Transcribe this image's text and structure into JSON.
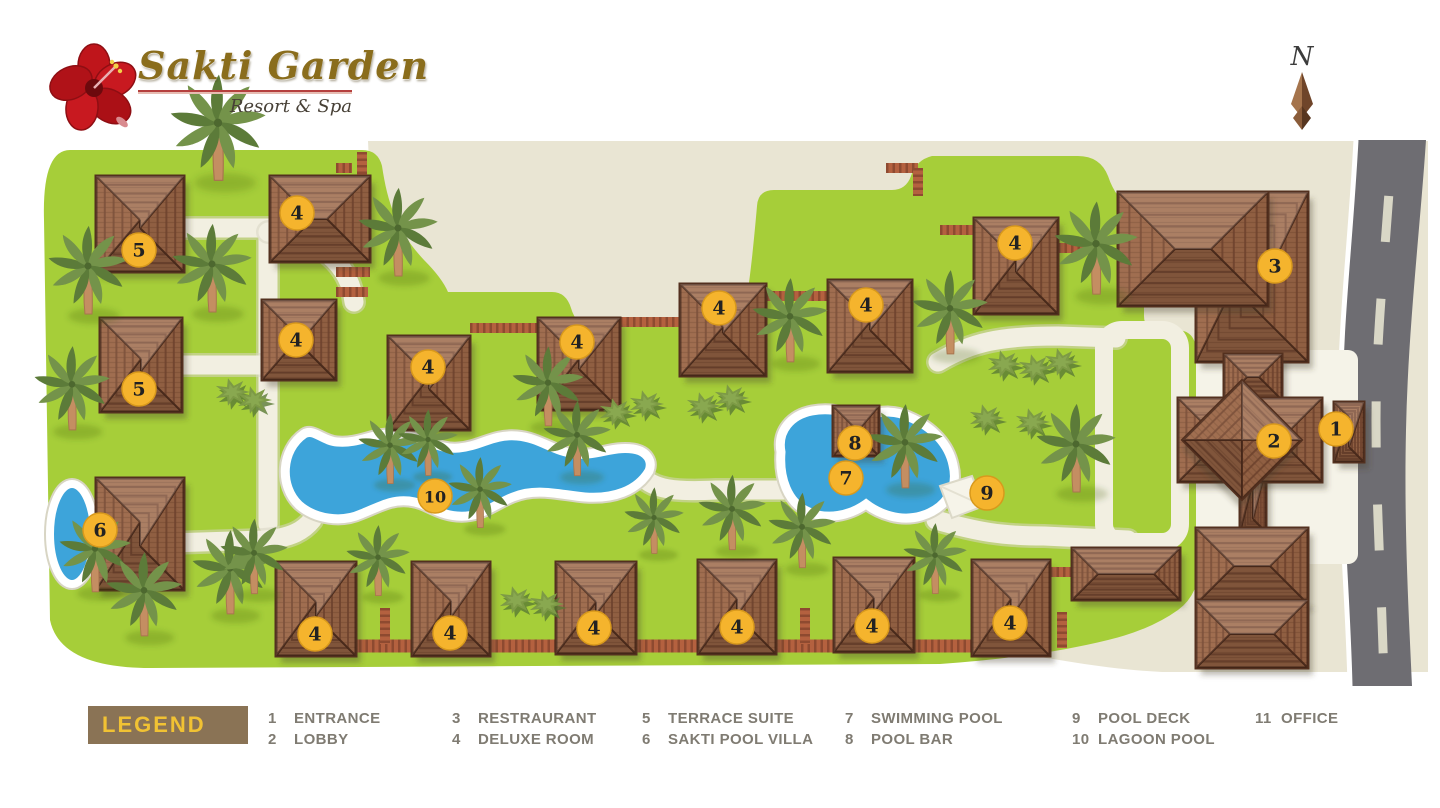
{
  "header": {
    "title": "Sakti Garden",
    "subtitle": "Resort & Spa",
    "logo": "hibiscus-flower-logo",
    "north_label": "N"
  },
  "legend": {
    "label": "LEGEND",
    "items": [
      {
        "num": "1",
        "label": "ENTRANCE"
      },
      {
        "num": "2",
        "label": "LOBBY"
      },
      {
        "num": "3",
        "label": "RESTRAURANT"
      },
      {
        "num": "4",
        "label": "DELUXE ROOM"
      },
      {
        "num": "5",
        "label": "TERRACE SUITE"
      },
      {
        "num": "6",
        "label": "SAKTI POOL VILLA"
      },
      {
        "num": "7",
        "label": "SWIMMING POOL"
      },
      {
        "num": "8",
        "label": "POOL BAR"
      },
      {
        "num": "9",
        "label": "POOL DECK"
      },
      {
        "num": "10",
        "label": "LAGOON POOL"
      },
      {
        "num": "11",
        "label": "OFFICE"
      }
    ],
    "column_lefts": [
      268,
      452,
      642,
      845,
      1072,
      1255
    ]
  },
  "map": {
    "colors": {
      "grass": "#a6ce39",
      "sand": "#e9e5d3",
      "road": "#6e6d72",
      "road_dash": "#d9d7c6",
      "road_stripe": "#ffffff",
      "path": "#f2efe1",
      "path_edge": "#d9d6c4",
      "water": "#3da4da",
      "water_rim": "#ffffff",
      "roof_base": "#9b6747",
      "roof_ring": "#754831",
      "roof_outline": "#53301f",
      "brick": "#b4613f",
      "brick_dark": "#8e4a30",
      "marker_bg": "#f5b42d",
      "marker_border": "#d8991c",
      "marker_text": "#222222",
      "palm_dark": "#5c7b39",
      "palm_light": "#74934a",
      "trunk": "#c48e62",
      "bush": "#7d9a46",
      "bush_dark": "#5a7a34",
      "plaza": "#f5f3e8",
      "deck": "#f6f4e9",
      "legend_box": "#8a7355",
      "legend_title": "#f1c233",
      "legend_text": "#7f7b72",
      "title_gold": "#8a6d1c",
      "underline_red": "#b5403e",
      "flower_red": "#c0161c"
    },
    "markers": [
      {
        "n": "5",
        "name": "terrace-suite",
        "x": 139,
        "y": 250
      },
      {
        "n": "5",
        "name": "terrace-suite",
        "x": 139,
        "y": 389
      },
      {
        "n": "4",
        "name": "deluxe-room",
        "x": 297,
        "y": 213
      },
      {
        "n": "4",
        "name": "deluxe-room",
        "x": 296,
        "y": 340
      },
      {
        "n": "4",
        "name": "deluxe-room",
        "x": 428,
        "y": 367
      },
      {
        "n": "4",
        "name": "deluxe-room",
        "x": 577,
        "y": 342
      },
      {
        "n": "4",
        "name": "deluxe-room",
        "x": 719,
        "y": 308
      },
      {
        "n": "4",
        "name": "deluxe-room",
        "x": 866,
        "y": 305
      },
      {
        "n": "4",
        "name": "deluxe-room",
        "x": 1015,
        "y": 243
      },
      {
        "n": "4",
        "name": "deluxe-room",
        "x": 315,
        "y": 634
      },
      {
        "n": "4",
        "name": "deluxe-room",
        "x": 450,
        "y": 633
      },
      {
        "n": "4",
        "name": "deluxe-room",
        "x": 594,
        "y": 628
      },
      {
        "n": "4",
        "name": "deluxe-room",
        "x": 737,
        "y": 627
      },
      {
        "n": "4",
        "name": "deluxe-room",
        "x": 872,
        "y": 626
      },
      {
        "n": "4",
        "name": "deluxe-room",
        "x": 1010,
        "y": 623
      },
      {
        "n": "6",
        "name": "sakti-pool-villa",
        "x": 100,
        "y": 530
      },
      {
        "n": "10",
        "name": "lagoon-pool",
        "x": 435,
        "y": 496
      },
      {
        "n": "7",
        "name": "swimming-pool",
        "x": 846,
        "y": 478
      },
      {
        "n": "8",
        "name": "pool-bar",
        "x": 855,
        "y": 443
      },
      {
        "n": "9",
        "name": "pool-deck",
        "x": 987,
        "y": 493
      },
      {
        "n": "3",
        "name": "restaurant",
        "x": 1275,
        "y": 266
      },
      {
        "n": "2",
        "name": "lobby",
        "x": 1274,
        "y": 441
      },
      {
        "n": "1",
        "name": "entrance",
        "x": 1336,
        "y": 429
      }
    ],
    "buildings": [
      {
        "name": "terrace-suite-building",
        "x": 96,
        "y": 176,
        "w": 88,
        "h": 96
      },
      {
        "name": "terrace-suite-building",
        "x": 100,
        "y": 318,
        "w": 82,
        "h": 94
      },
      {
        "name": "deluxe-room-building",
        "x": 270,
        "y": 176,
        "w": 100,
        "h": 86
      },
      {
        "name": "deluxe-room-building",
        "x": 262,
        "y": 300,
        "w": 74,
        "h": 80
      },
      {
        "name": "deluxe-room-building",
        "x": 388,
        "y": 336,
        "w": 82,
        "h": 94
      },
      {
        "name": "deluxe-room-building",
        "x": 538,
        "y": 318,
        "w": 82,
        "h": 92
      },
      {
        "name": "deluxe-room-building",
        "x": 680,
        "y": 284,
        "w": 86,
        "h": 92
      },
      {
        "name": "deluxe-room-building",
        "x": 828,
        "y": 280,
        "w": 84,
        "h": 92
      },
      {
        "name": "deluxe-room-building",
        "x": 974,
        "y": 218,
        "w": 84,
        "h": 96
      },
      {
        "name": "deluxe-room-building",
        "x": 276,
        "y": 562,
        "w": 80,
        "h": 94
      },
      {
        "name": "deluxe-room-building",
        "x": 412,
        "y": 562,
        "w": 78,
        "h": 94
      },
      {
        "name": "deluxe-room-building",
        "x": 556,
        "y": 562,
        "w": 80,
        "h": 92
      },
      {
        "name": "deluxe-room-building",
        "x": 698,
        "y": 560,
        "w": 78,
        "h": 94
      },
      {
        "name": "deluxe-room-building",
        "x": 834,
        "y": 558,
        "w": 80,
        "h": 94
      },
      {
        "name": "deluxe-room-building",
        "x": 972,
        "y": 560,
        "w": 78,
        "h": 96
      },
      {
        "name": "sakti-pool-villa-building",
        "x": 96,
        "y": 478,
        "w": 88,
        "h": 112
      },
      {
        "name": "restaurant-building",
        "x": 1196,
        "y": 192,
        "w": 112,
        "h": 170
      },
      {
        "name": "restaurant-building",
        "x": 1118,
        "y": 192,
        "w": 150,
        "h": 114
      },
      {
        "name": "restaurant-corridor",
        "x": 1224,
        "y": 354,
        "w": 58,
        "h": 46
      },
      {
        "name": "lobby-corridor",
        "x": 1240,
        "y": 468,
        "w": 26,
        "h": 64
      },
      {
        "name": "spa-building",
        "x": 1196,
        "y": 528,
        "w": 112,
        "h": 76
      },
      {
        "name": "spa-building",
        "x": 1196,
        "y": 600,
        "w": 112,
        "h": 68
      },
      {
        "name": "lobby-building",
        "x": 1178,
        "y": 398,
        "w": 144,
        "h": 84
      },
      {
        "name": "lobby-building",
        "x": 1200,
        "y": 398,
        "w": 84,
        "h": 84,
        "rot": 45
      },
      {
        "name": "office-building",
        "x": 1072,
        "y": 548,
        "w": 108,
        "h": 52
      },
      {
        "name": "pool-bar-building",
        "x": 833,
        "y": 406,
        "w": 46,
        "h": 50
      },
      {
        "name": "entrance-building",
        "x": 1334,
        "y": 402,
        "w": 30,
        "h": 60
      }
    ],
    "shapes": {
      "sand": "M 368,141 L 1428,141 L 1428,672 L 1162,672 C 1082,668 1022,650 962,648 L 430,648 L 395,520 L 375,300 Z",
      "grass": "M 70,150 L 362,150 Q 378,150 382,166 C 388,206 398,232 424,260 Q 442,278 448,292 L 552,292 Q 566,292 571,308 Q 576,326 592,326 L 724,326 Q 740,326 745,308 C 750,282 754,240 757,206 Q 758,190 774,190 L 892,190 Q 906,190 911,176 Q 916,160 932,156 L 1078,156 Q 1100,156 1108,176 Q 1116,200 1134,210 Q 1144,216 1144,232 L 1144,316 Q 1144,330 1160,330 L 1176,330 Q 1196,330 1196,352 L 1200,560 Q 1200,594 1178,610 Q 1150,630 1108,640 C 1060,652 1000,660 940,664 L 150,668 Q 60,668 50,620 L 44,220 Q 42,150 70,150 Z",
      "road": "M 1358,140 C 1352,250 1342,320 1342,420 C 1342,520 1350,600 1352,686 L 1412,686 C 1408,600 1404,520 1406,430 C 1408,330 1420,230 1426,140 Z",
      "road_stripe_left": "M 1356,140 C 1350,250 1340,320 1340,420 C 1340,520 1348,600 1350,686",
      "road_center": "M 1392,146 C 1386,250 1376,330 1376,420 C 1376,510 1382,590 1384,686",
      "plaza_rect": {
        "x": 1196,
        "y": 350,
        "w": 162,
        "h": 214
      },
      "walkways": [
        "M 183,228 L 268,228 L 268,524",
        "M 183,365 L 268,365",
        "M 268,232 C 322,238 350,266 354,302",
        "M 78,546 L 264,540 C 292,538 304,530 312,520",
        "M 640,474 C 652,490 676,492 716,490 L 806,490",
        "M 936,520 C 978,532 1002,536 1044,536 L 1128,540",
        "M 938,362 C 972,342 1000,336 1058,336 L 1116,338"
      ],
      "plaza_ring": {
        "x": 1104,
        "y": 330,
        "w": 76,
        "h": 212,
        "rx": 18
      },
      "bricks": [
        {
          "d": "M 336,168 L 352,168"
        },
        {
          "d": "M 362,152 L 362,186"
        },
        {
          "d": "M 336,272 L 370,272"
        },
        {
          "d": "M 336,292 L 368,292"
        },
        {
          "d": "M 470,328 L 538,328"
        },
        {
          "d": "M 620,322 L 680,322"
        },
        {
          "d": "M 766,296 L 828,296"
        },
        {
          "d": "M 886,168 L 918,168"
        },
        {
          "d": "M 918,168 L 918,196"
        },
        {
          "d": "M 940,230 L 974,230"
        },
        {
          "d": "M 1058,248 L 1096,248"
        },
        {
          "d": "M 320,646 L 1012,646",
          "w": 13
        },
        {
          "d": "M 385,608 L 385,644"
        },
        {
          "d": "M 805,608 L 805,644"
        },
        {
          "d": "M 1062,612 L 1062,648"
        },
        {
          "d": "M 1050,572 L 1072,572"
        }
      ],
      "lagoon_pool": "M 304,434 C 281,450 279,486 299,505 C 315,519 341,523 361,514 C 379,507 391,499 409,501 C 427,503 435,514 457,516 C 481,518 493,505 513,497 C 537,487 561,495 585,497 C 613,499 637,491 649,471 C 653,461 647,451 633,449 C 613,446 597,456 577,454 C 553,452 541,438 517,436 C 493,434 481,446 459,448 C 437,450 421,436 397,434 C 373,432 361,444 337,442 C 323,441 313,428 304,434 Z",
      "swimming_pool": "M 781,452 C 777,431 791,415 812,411 C 833,407 849,413 859,421 C 872,411 893,409 909,417 C 933,427 949,445 953,465 C 959,489 945,509 921,516 C 900,522 879,514 866,504 C 849,516 827,520 809,512 C 787,503 779,477 781,452 Z",
      "villa_pool": {
        "cx": 72,
        "cy": 534,
        "rx": 22,
        "ry": 50
      },
      "deck": "M 940,486 L 972,476 L 984,506 L 952,518 Z"
    },
    "trees": [
      [
        218,
        178,
        1.2
      ],
      [
        88,
        312,
        1.0
      ],
      [
        212,
        310,
        1.0
      ],
      [
        72,
        428,
        0.95
      ],
      [
        95,
        590,
        0.9
      ],
      [
        144,
        634,
        0.95
      ],
      [
        230,
        612,
        0.95
      ],
      [
        398,
        274,
        1.0
      ],
      [
        548,
        424,
        0.9
      ],
      [
        390,
        482,
        0.8
      ],
      [
        428,
        474,
        0.75
      ],
      [
        577,
        474,
        0.85
      ],
      [
        790,
        360,
        0.95
      ],
      [
        950,
        352,
        0.95
      ],
      [
        1096,
        292,
        1.05
      ],
      [
        905,
        486,
        0.95
      ],
      [
        1076,
        490,
        1.0
      ],
      [
        732,
        548,
        0.85
      ],
      [
        802,
        566,
        0.85
      ],
      [
        480,
        526,
        0.8
      ],
      [
        654,
        552,
        0.75
      ],
      [
        254,
        592,
        0.85
      ],
      [
        378,
        594,
        0.8
      ],
      [
        935,
        592,
        0.8
      ]
    ],
    "bushes": [
      [
        232,
        392
      ],
      [
        254,
        400
      ],
      [
        616,
        412
      ],
      [
        646,
        404
      ],
      [
        703,
        406
      ],
      [
        731,
        398
      ],
      [
        986,
        418
      ],
      [
        1032,
        422
      ],
      [
        1004,
        364
      ],
      [
        1035,
        368
      ],
      [
        1061,
        362
      ],
      [
        516,
        600
      ],
      [
        546,
        604
      ]
    ]
  }
}
